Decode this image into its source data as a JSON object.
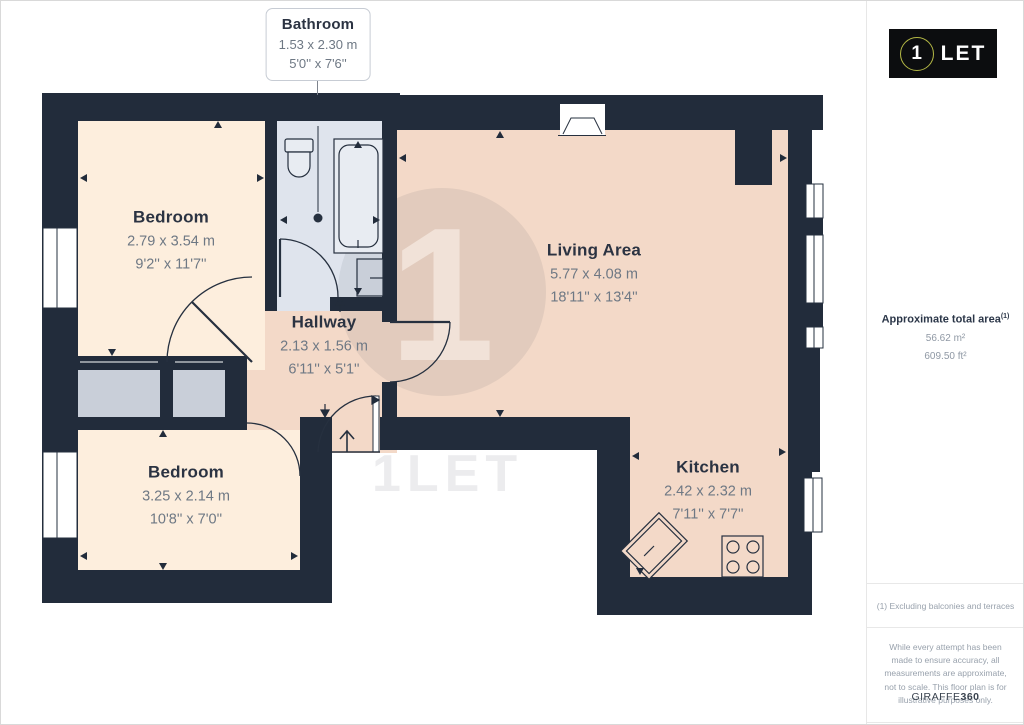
{
  "floorplan": {
    "callout": {
      "name": "Bathroom",
      "metric": "1.53 x 2.30 m",
      "imperial": "5'0'' x 7'6''"
    },
    "rooms": [
      {
        "id": "bedroom-1",
        "name": "Bedroom",
        "metric": "2.79 x 3.54 m",
        "imperial": "9'2'' x 11'7''"
      },
      {
        "id": "living-area",
        "name": "Living Area",
        "metric": "5.77 x 4.08 m",
        "imperial": "18'11'' x 13'4''"
      },
      {
        "id": "hallway",
        "name": "Hallway",
        "metric": "2.13 x 1.56 m",
        "imperial": "6'11'' x 5'1''"
      },
      {
        "id": "bedroom-2",
        "name": "Bedroom",
        "metric": "3.25 x 2.14 m",
        "imperial": "10'8'' x 7'0''"
      },
      {
        "id": "kitchen",
        "name": "Kitchen",
        "metric": "2.42 x 2.32 m",
        "imperial": "7'11'' x 7'7''"
      }
    ],
    "watermark": {
      "circle_letter": "1",
      "logo_text": "1LET"
    },
    "colors": {
      "wall": "#222c3b",
      "bedroom_floor": "#fdeedd",
      "living_floor": "#f3d9c8",
      "bathroom_floor": "#dfe4ed",
      "storage_floor": "#c9cfd9",
      "logo_accent": "#b4b845"
    }
  },
  "sidebar": {
    "logo": {
      "number": "1",
      "text": "LET"
    },
    "area": {
      "label": "Approximate total area",
      "sup": "(1)",
      "metric": "56.62 m²",
      "imperial": "609.50 ft²"
    },
    "footnote": "(1) Excluding balconies and terraces",
    "disclaimer": "While every attempt has been made to ensure accuracy, all measurements are approximate, not to scale. This floor plan is for illustrative purposes only.",
    "brand": {
      "name": "GIRAFFE",
      "suffix": "360"
    }
  }
}
